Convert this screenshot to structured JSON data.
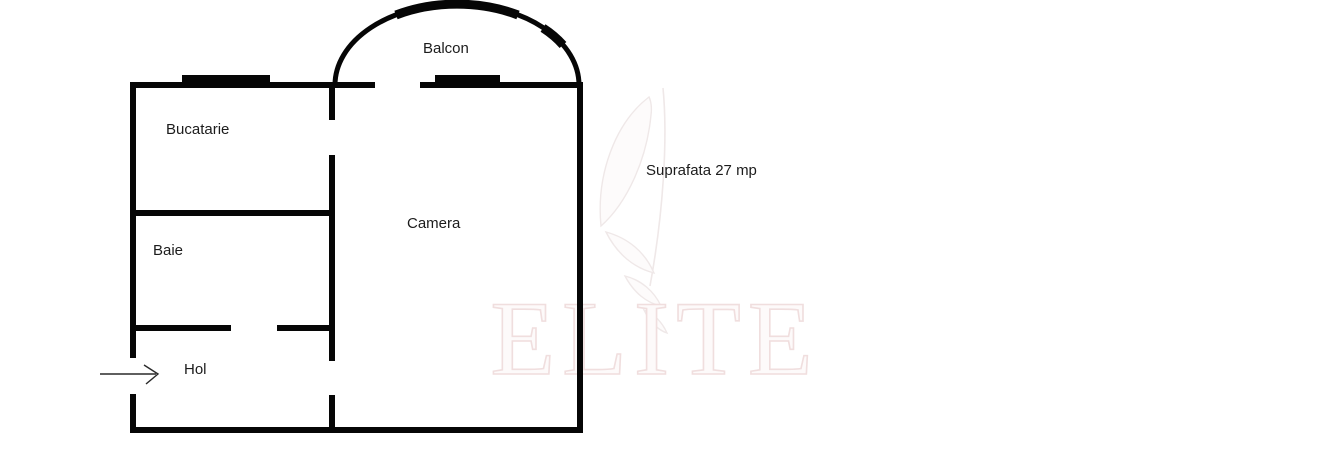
{
  "floorplan": {
    "rooms": [
      {
        "id": "balcon",
        "label": "Balcon"
      },
      {
        "id": "bucatarie",
        "label": "Bucatarie"
      },
      {
        "id": "camera",
        "label": "Camera"
      },
      {
        "id": "baie",
        "label": "Baie"
      },
      {
        "id": "hol",
        "label": "Hol"
      }
    ],
    "area_note": "Suprafata 27 mp",
    "entrance_arrow": "entrance-direction-right"
  },
  "watermark": {
    "text": "ELITE"
  },
  "colors": {
    "page-bg": "#ffffff",
    "wall": "#060606",
    "text": "#1c1c1c",
    "wm-stroke": "#f0dede",
    "wm-fill": "#fdfafa",
    "logo-stroke": "#efe8e8"
  }
}
